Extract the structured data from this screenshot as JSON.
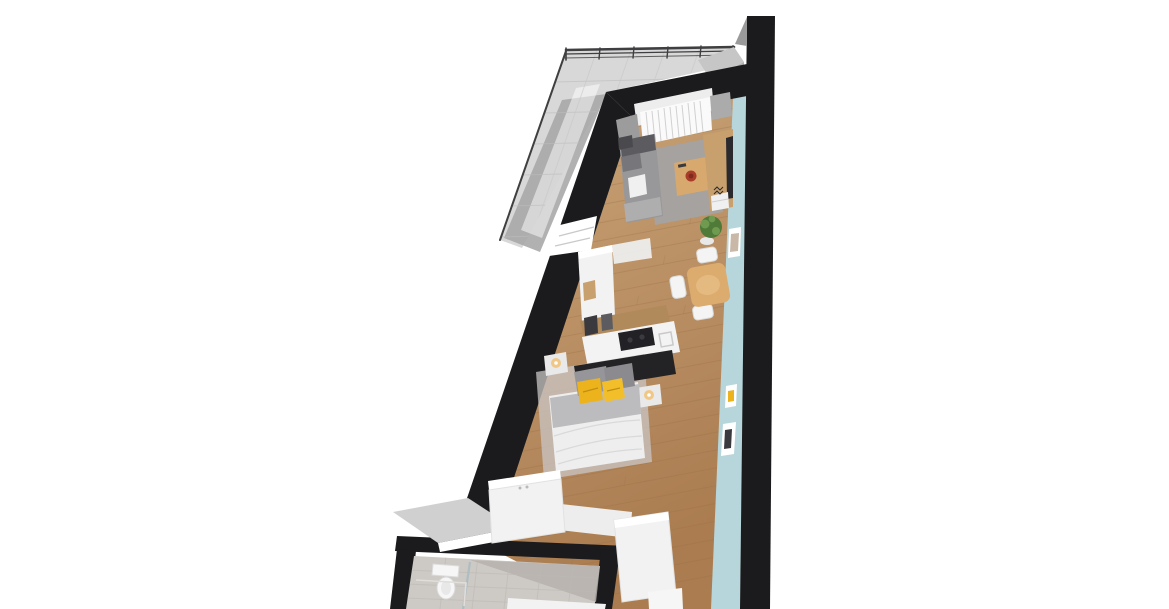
{
  "scene": {
    "kind": "Top-down 3D architectural render of a narrow wedge-shaped studio apartment floor plan on a white background",
    "areas": [
      {
        "name": "balcony",
        "items": [
          "metal-railing",
          "concrete-tile-floor"
        ]
      },
      {
        "name": "living-area",
        "items": [
          "window-with-curtains",
          "corner-sofa",
          "gray-rug",
          "coffee-table",
          "red-bowl",
          "tv-cabinet",
          "potted-plant"
        ]
      },
      {
        "name": "dining-area",
        "items": [
          "wooden-table",
          "white-chairs",
          "picture-frame"
        ]
      },
      {
        "name": "kitchenette",
        "items": [
          "tall-white-cabinet",
          "appliance-shelf",
          "white-counter",
          "black-cooktop"
        ]
      },
      {
        "name": "sleeping-area",
        "items": [
          "double-bed",
          "yellow-pillows",
          "gray-blanket",
          "nightstand-lamps",
          "bed-rug",
          "white-wardrobe"
        ]
      },
      {
        "name": "bathroom",
        "items": [
          "toilet",
          "shower-glass-screen",
          "vanity-cabinet",
          "tile-floor"
        ]
      }
    ]
  },
  "colors": {
    "background": "#ffffff",
    "wall": "#1b1b1d",
    "wall_bevel": "#9a9a9a",
    "balcony_floor": "#d8d8d8",
    "balcony_dark": "#a9a9a9",
    "balcony_streak": "#ffffff",
    "railing": "#3f3f41",
    "parapet_light": "#c6c6c6",
    "parapet_dark": "#b0b0b0",
    "cap_gray": "#d0d0d0",
    "wood_light": "#c9a478",
    "wood_dark": "#aa7c50",
    "accent_wall_blue": "#b7d6db",
    "window_frame": "#ededed",
    "curtain": "#fafafa",
    "window_side_left": "#9c9c9c",
    "window_side_right": "#ababab",
    "rug": "#a5a2a0",
    "sofa": "#98989a",
    "sofa_dark": "#5c5c60",
    "sofa_mid": "#77777b",
    "sofa_arm": "#aeaeae",
    "throw_dark": "#4a4a4e",
    "pillow_white": "#f0f0f0",
    "coffee_table": "#d8a96e",
    "bowl_red": "#a83c2b",
    "bowl_red_dark": "#7e2a1f",
    "tv_wood": "#c8a06d",
    "tv_screen": "#2a2a2e",
    "plant_green": "#4f7a38",
    "plant_light": "#6f9b50",
    "pot_white": "#e8e8e8",
    "dining_table": "#dcab6e",
    "dining_table_light": "#e8c089",
    "chair_white": "#f4f4f4",
    "cabinet_white": "#f2f2f2",
    "cabinet_top": "#ffffff",
    "cabinet_inset_wood": "#c8a06d",
    "shelf_wood": "#b08a5a",
    "appliance_dark": "#3a3a3e",
    "counter_white": "#f3f3f3",
    "cooktop": "#222226",
    "headboard": "#232326",
    "bed_rug": "#c9c6c4",
    "pillow_gray": "#96969a",
    "pillow_gray2": "#8b8b8f",
    "pillow_yellow": "#ecb31d",
    "pillow_yellow2": "#f2bf2a",
    "duvet": "#eeeeee",
    "blanket_gray": "#bcbcbe",
    "lamp_glow": "#f2c37c",
    "nightstand": "#e9e9e9",
    "bath_floor": "#cdc9c4",
    "bath_floor_dark": "#b6b2ad",
    "fixture_white": "#f6f6f6",
    "glass": "#a8bcc2",
    "frame_white": "#ffffff",
    "photo_tint": "#c9b8a8"
  }
}
